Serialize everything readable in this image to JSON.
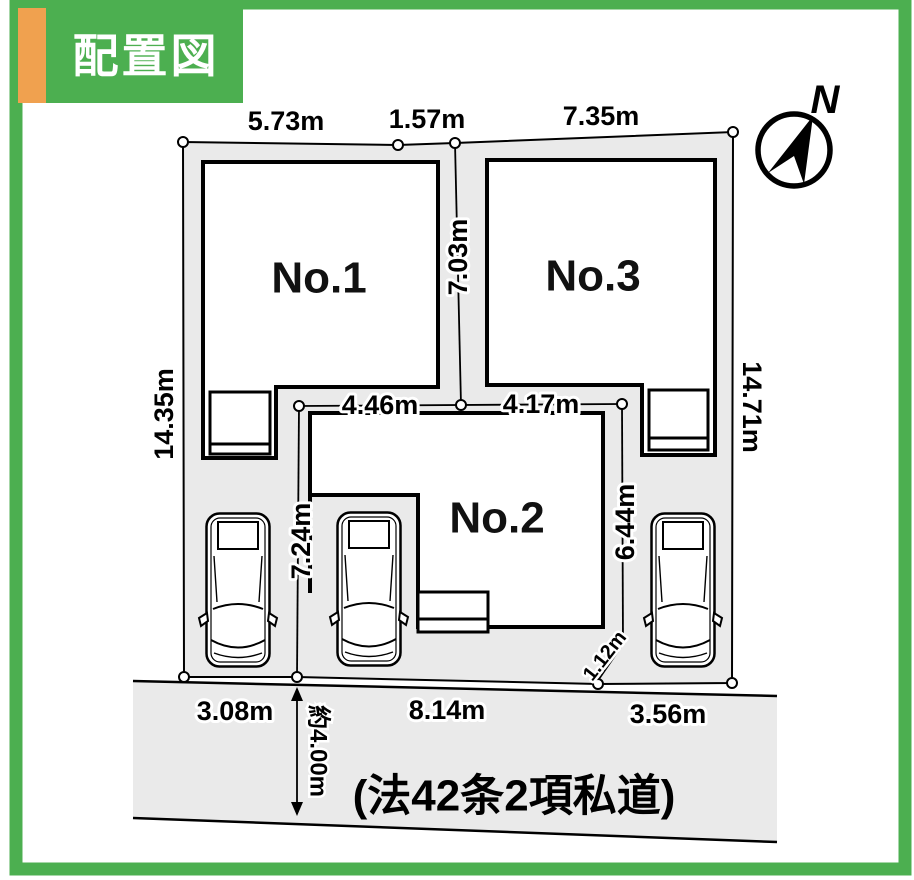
{
  "header": {
    "title": "配置図"
  },
  "compass": {
    "label": "N"
  },
  "plots": [
    {
      "label": "No.1"
    },
    {
      "label": "No.2"
    },
    {
      "label": "No.3"
    }
  ],
  "dims": {
    "top": [
      "5.73m",
      "1.57m",
      "7.35m"
    ],
    "left": "14.35m",
    "right": "14.71m",
    "center_vertical": "7.03m",
    "mid_left": "4.46m",
    "mid_right": "4.17m",
    "inner_left": "7.24m",
    "inner_right": "6.44m",
    "diagonal": "1.12m",
    "bottom": [
      "3.08m",
      "8.14m",
      "3.56m"
    ],
    "road_width": "約4.00m"
  },
  "road": {
    "label": "(法42条2項私道)"
  },
  "colors": {
    "frame_green": "#4caf50",
    "accent_orange": "#f0a14f",
    "site_gray": "#eaeaea",
    "line_black": "#000000"
  }
}
